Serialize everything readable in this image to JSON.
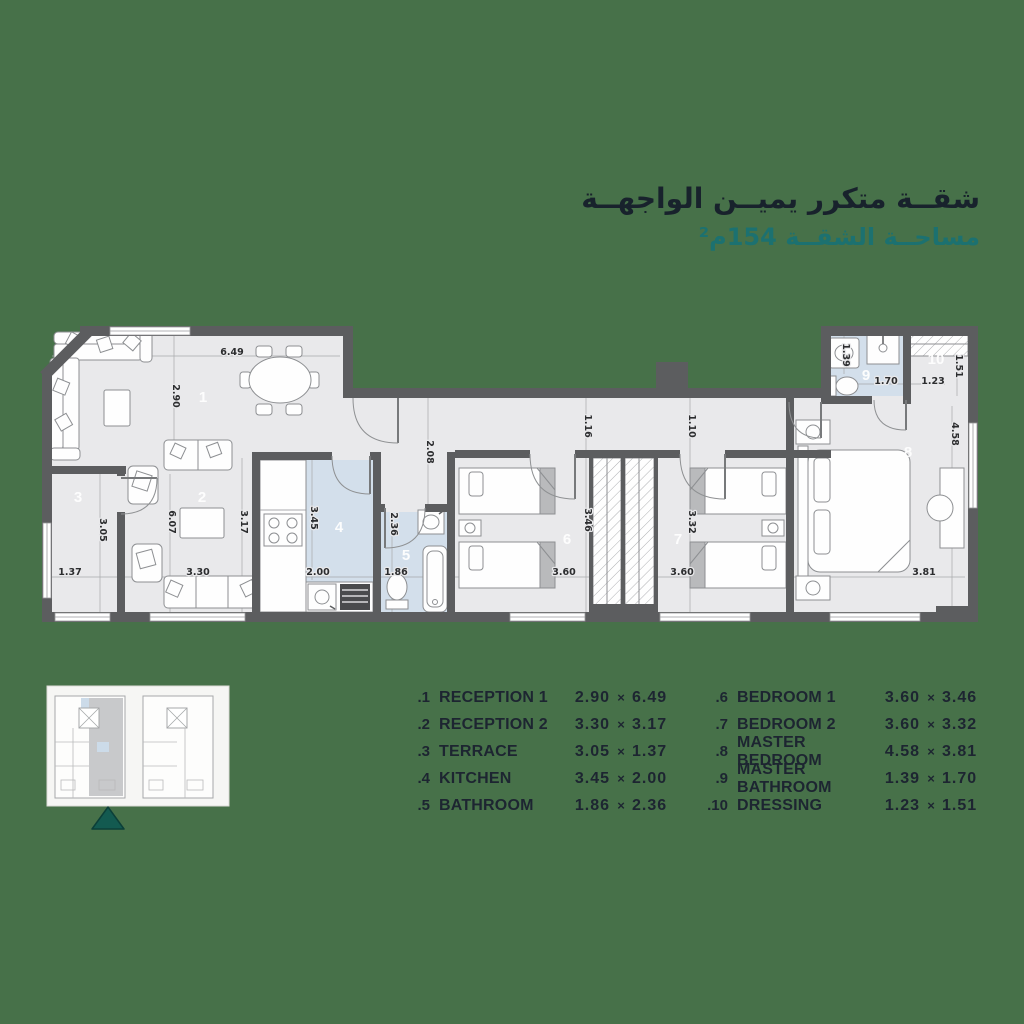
{
  "title": {
    "line1": "شقــة متكرر يميــن الواجهــة",
    "line2": "مساحــة الشقــة 154م²"
  },
  "colors": {
    "background": "#477149",
    "title_ink": "#18222C",
    "teal_accent": "#1C7170",
    "wall": "#5C5D5F",
    "room_fill": "#E9E9EB",
    "wet_room_blue": "#D3DFEB",
    "triangle": "#135A50"
  },
  "plan": {
    "rooms": {
      "r1": "1",
      "r2": "2",
      "r3": "3",
      "r4": "4",
      "r5": "5",
      "r6": "6",
      "r7": "7",
      "r8": "8",
      "r9": "9",
      "r10": "10"
    },
    "dims": {
      "d649": "6.49",
      "d290": "2.90",
      "d305": "3.05",
      "d137": "1.37",
      "d607": "6.07",
      "d317": "3.17",
      "d330": "3.30",
      "d345": "3.45",
      "d200": "2.00",
      "d236": "2.36",
      "d186": "1.86",
      "d208": "2.08",
      "d116": "1.16",
      "d110": "1.10",
      "d346": "3.46",
      "d360a": "3.60",
      "d360b": "3.60",
      "d332": "3.32",
      "d458": "4.58",
      "d381": "3.81",
      "d139": "1.39",
      "d170": "1.70",
      "d123": "1.23",
      "d151": "1.51"
    }
  },
  "legend": {
    "sep": "×",
    "left": [
      {
        "num": ".1",
        "name": "RECEPTION  1",
        "d1": "2.90",
        "d2": "6.49"
      },
      {
        "num": ".2",
        "name": "RECEPTION  2",
        "d1": "3.30",
        "d2": "3.17"
      },
      {
        "num": ".3",
        "name": "TERRACE",
        "d1": "3.05",
        "d2": "1.37"
      },
      {
        "num": ".4",
        "name": "KITCHEN",
        "d1": "3.45",
        "d2": "2.00"
      },
      {
        "num": ".5",
        "name": "BATHROOM",
        "d1": "1.86",
        "d2": "2.36"
      }
    ],
    "right": [
      {
        "num": ".6",
        "name": "BEDROOM  1",
        "d1": "3.60",
        "d2": "3.46"
      },
      {
        "num": ".7",
        "name": "BEDROOM  2",
        "d1": "3.60",
        "d2": "3.32"
      },
      {
        "num": ".8",
        "name": "MASTER BEDROOM",
        "d1": "4.58",
        "d2": "3.81"
      },
      {
        "num": ".9",
        "name": "MASTER BATHROOM",
        "d1": "1.39",
        "d2": "1.70"
      },
      {
        "num": ".10",
        "name": "DRESSING",
        "d1": "1.23",
        "d2": "1.51"
      }
    ]
  }
}
